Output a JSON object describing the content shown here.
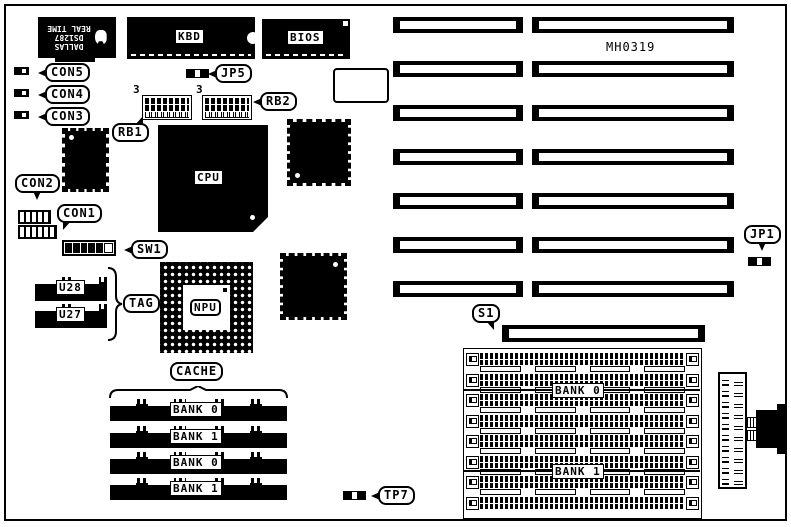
{
  "board": {
    "part_number": "MH0319"
  },
  "chips": {
    "rtc": {
      "lines": [
        "DALLAS",
        "DS1287",
        "REAL TIME"
      ]
    },
    "kbd": {
      "label": "KBD"
    },
    "bios": {
      "label": "BIOS"
    },
    "cpu": {
      "label": "CPU"
    },
    "npu": {
      "label": "NPU"
    },
    "u28": {
      "label": "U28"
    },
    "u27": {
      "label": "U27"
    }
  },
  "callouts": {
    "con5": "CON5",
    "con4": "CON4",
    "con3": "CON3",
    "con2": "CON2",
    "con1": "CON1",
    "jp5": "JP5",
    "jp1": "JP1",
    "rb1": "RB1",
    "rb2": "RB2",
    "sw1": "SW1",
    "tag": "TAG",
    "cache": "CACHE",
    "s1": "S1",
    "tp7": "TP7"
  },
  "annotations": {
    "rb1_pin1": "3",
    "rb2_pin1": "3"
  },
  "cache_banks": [
    "BANK 0",
    "BANK 1",
    "BANK 0",
    "BANK 1"
  ],
  "simm": {
    "banks": [
      "BANK 0",
      "BANK 1"
    ],
    "socket_rows": 8
  },
  "expansion_slots": {
    "rows": 7,
    "columns": 2
  }
}
